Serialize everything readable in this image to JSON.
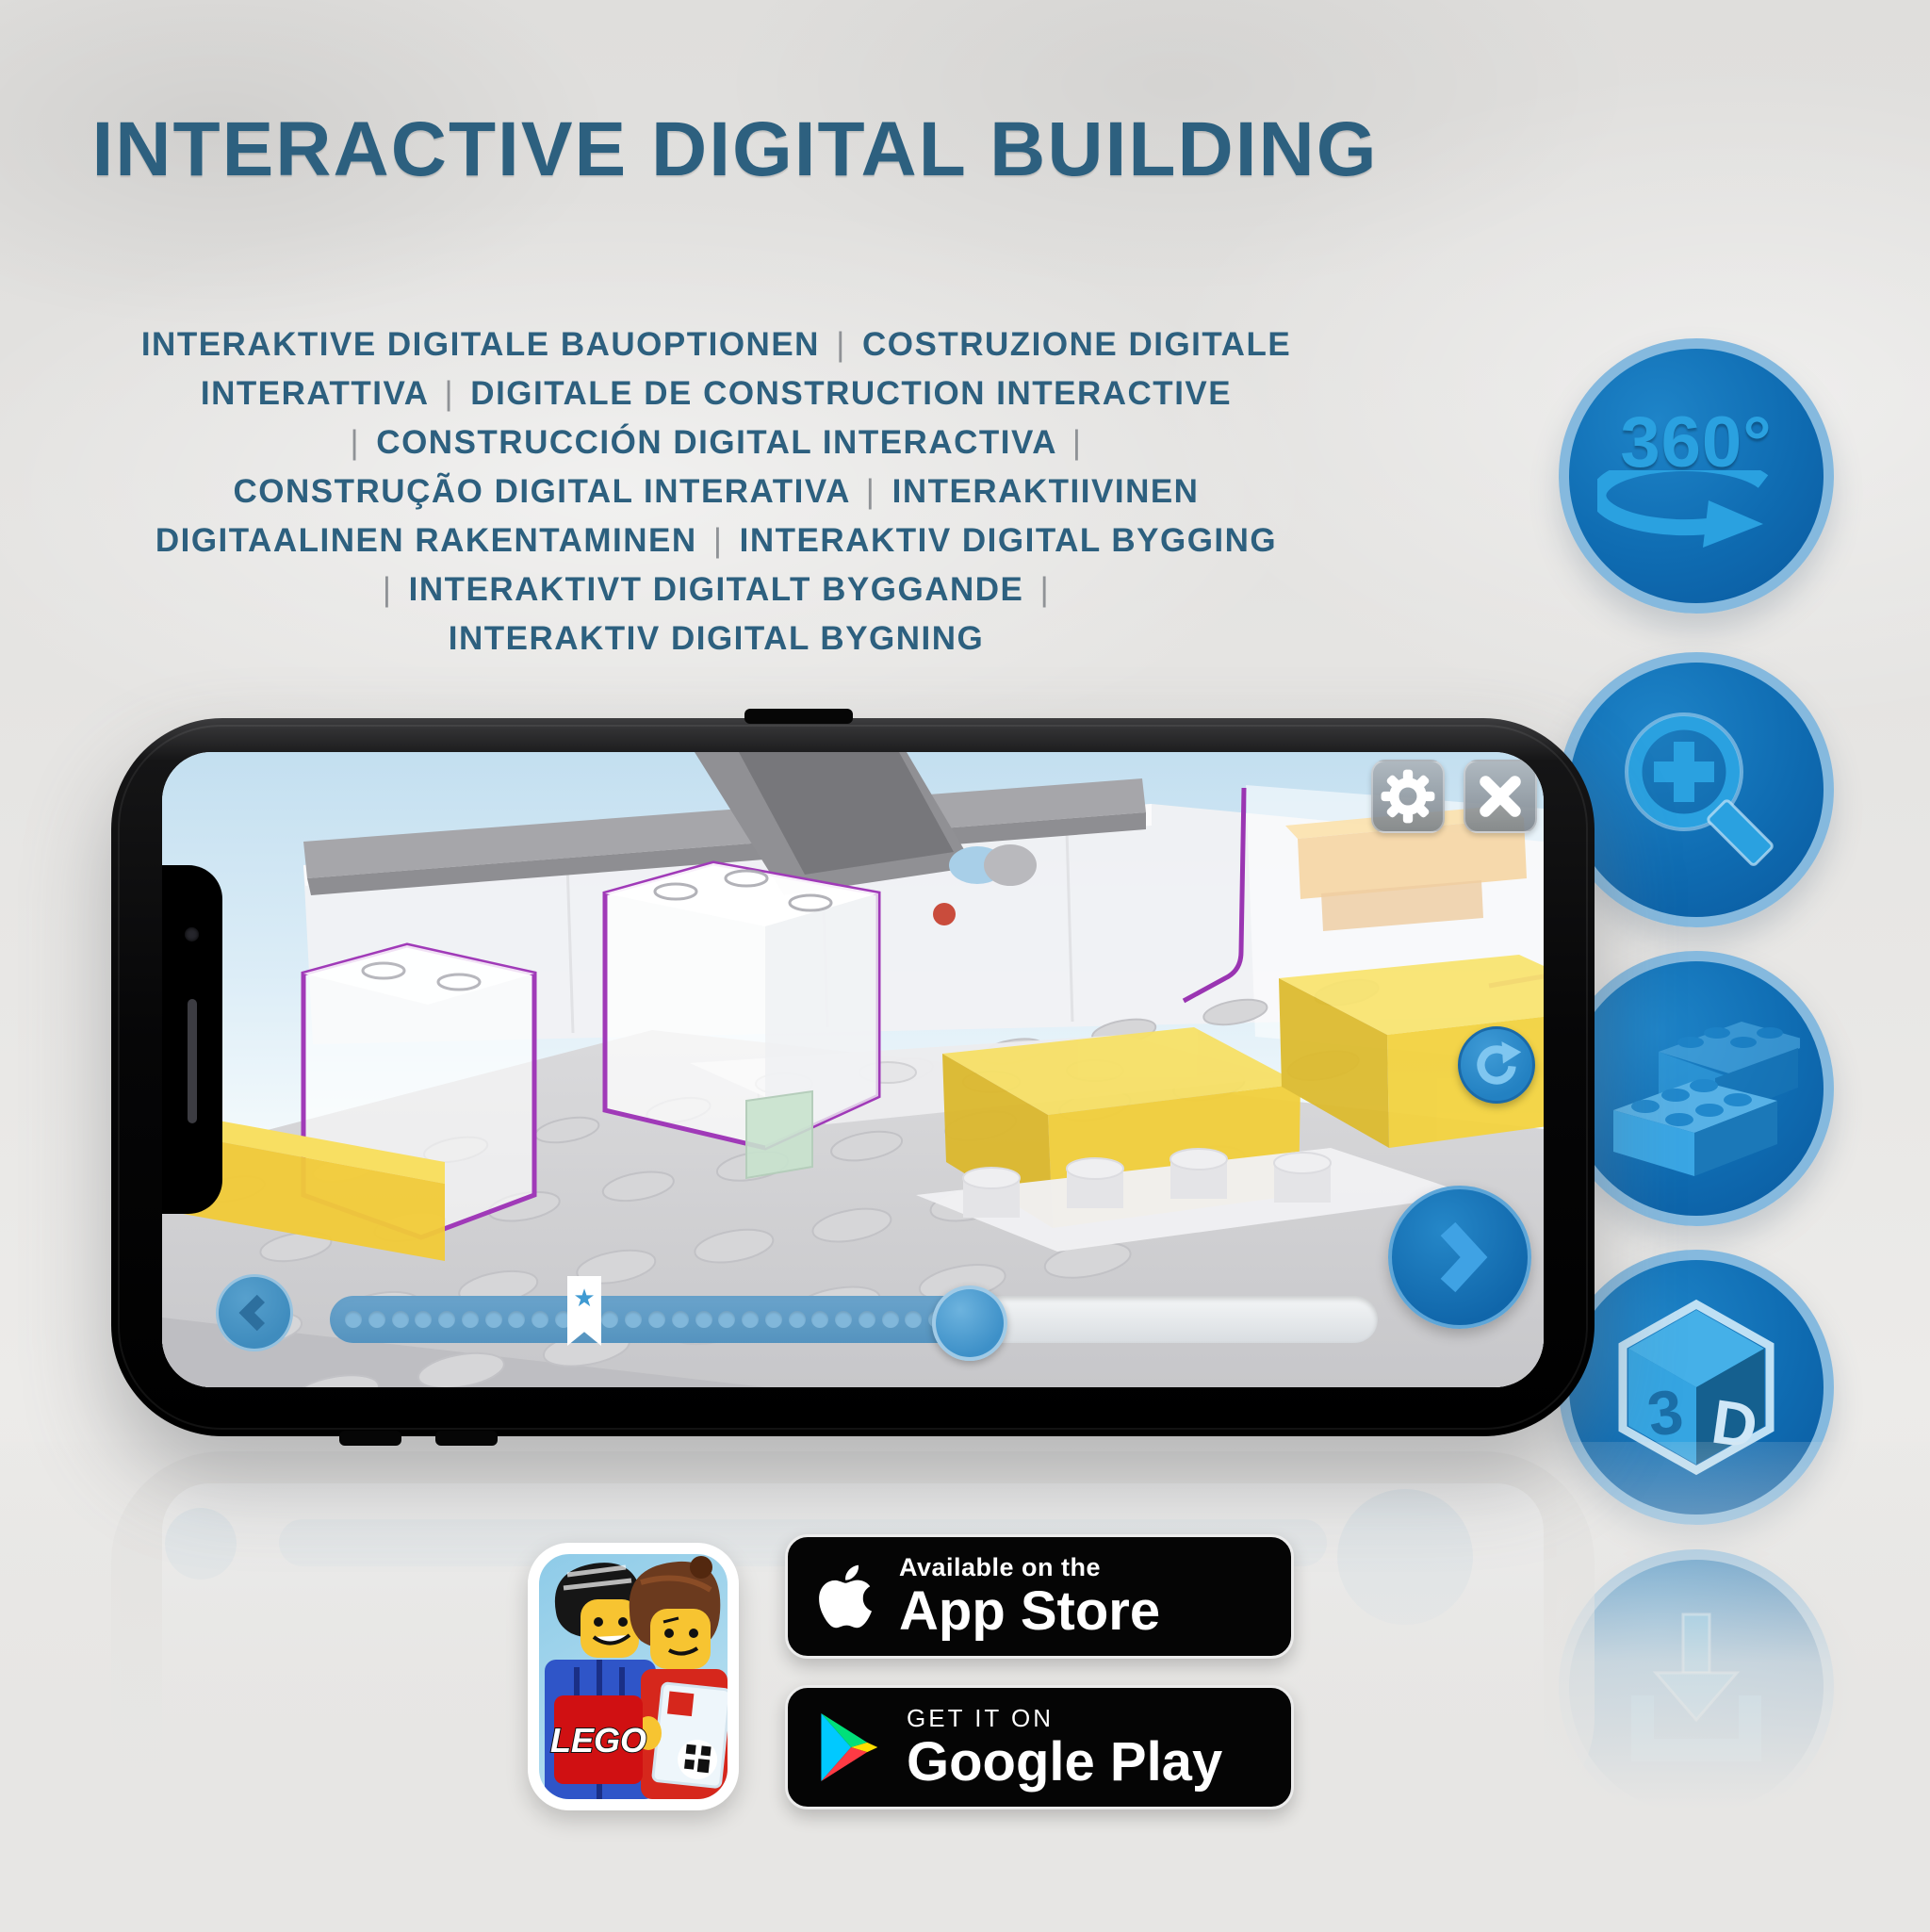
{
  "page": {
    "background_color": "#e3e2e0",
    "title": "INTERACTIVE DIGITAL BUILDING",
    "title_color": "#2d607f",
    "subtitle_lines": [
      "INTERAKTIVE DIGITALE BAUOPTIONEN | COSTRUZIONE DIGITALE",
      "INTERATTIVA | DIGITALE DE CONSTRUCTION INTERACTIVE",
      "| CONSTRUCCIÓN DIGITAL INTERACTIVA |",
      "CONSTRUÇÃO DIGITAL INTERATIVA | INTERAKTIIVINEN",
      "DIGITAALINEN RAKENTAMINEN | INTERAKTIV DIGITAL BYGGING",
      "| INTERAKTIVT DIGITALT BYGGANDE |",
      "INTERAKTIV DIGITAL BYGNING"
    ]
  },
  "features": {
    "circle_color": "#0f6cb2",
    "ring_color": "#85b9de",
    "glyph_color": "#2aa1e0",
    "items": [
      {
        "name": "rotate-360-icon",
        "label": "360°"
      },
      {
        "name": "zoom-in-icon"
      },
      {
        "name": "building-bricks-icon"
      },
      {
        "name": "view-3d-icon",
        "left_face": "3",
        "right_face": "D"
      },
      {
        "name": "download-icon"
      }
    ]
  },
  "phone_app": {
    "toolbar": {
      "settings_icon": "gear",
      "close_icon": "x"
    },
    "nav": {
      "back_icon": "chevron-left",
      "next_icon": "chevron-right",
      "refresh_icon": "rotate-clockwise"
    },
    "progress": {
      "dot_count": 26,
      "fill_ratio": 0.61,
      "bookmark_dot": 10,
      "bookmark_icon": "★"
    }
  },
  "store": {
    "lego_app_logo": "LEGO",
    "app_store_badge": {
      "tagline": "Available on the",
      "store_name": "App Store"
    },
    "google_play_badge": {
      "tagline": "GET IT ON",
      "store_name": "Google Play"
    }
  },
  "colors": {
    "lego_red": "#d01012",
    "play_cyan": "#00c9ff",
    "play_green": "#00e07a",
    "play_yellow": "#ffde00",
    "play_pink": "#ff3a44",
    "brick_yellow": "#f2cf3a",
    "outline_purple": "#a03ab8"
  }
}
